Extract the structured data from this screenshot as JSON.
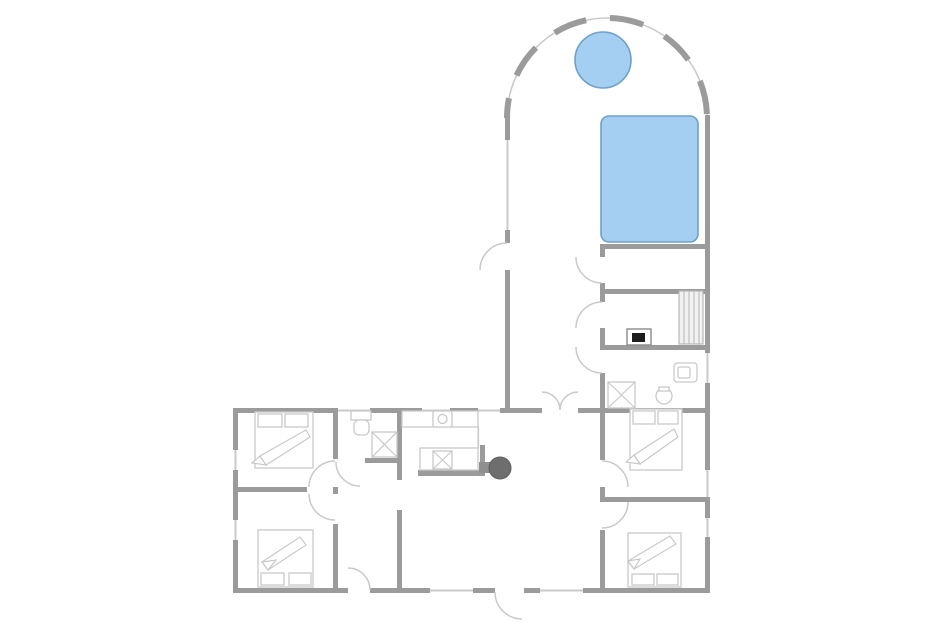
{
  "canvas": {
    "width": 950,
    "height": 634
  },
  "palette": {
    "bg": "#ffffff",
    "wall": "#9b9b9b",
    "window": "#c9c9c9",
    "fixture": "#c9c9c9",
    "water-fill": "#a5cff2",
    "water-stroke": "#6fa0c8",
    "heater": "#1c1c1c"
  },
  "shapes": [
    {
      "name": "arch-wall-underlay",
      "tag": "path",
      "cls": "archline",
      "d": "M 507 118 A 100 100 0 0 1 707 118"
    },
    {
      "name": "arch-wall-dashes",
      "tag": "path",
      "cls": "archdash",
      "d": "M 507 118 A 100 100 0 0 1 707 118",
      "dash": "34 24",
      "doff": "14"
    },
    {
      "name": "pool-left-wall-upper",
      "tag": "rect",
      "cls": "wall",
      "x": 505,
      "y": 115,
      "w": 5,
      "h": 25
    },
    {
      "name": "pool-left-wall-window",
      "tag": "rect",
      "cls": "win",
      "x": 506.5,
      "y": 140,
      "w": 2,
      "h": 90
    },
    {
      "name": "pool-left-wall-stub",
      "tag": "rect",
      "cls": "wall",
      "x": 505,
      "y": 230,
      "w": 5,
      "h": 13
    },
    {
      "name": "pool-left-wall-lower",
      "tag": "rect",
      "cls": "wall",
      "x": 505,
      "y": 270,
      "w": 5,
      "h": 138
    },
    {
      "name": "right-wall-upper",
      "tag": "rect",
      "cls": "wall",
      "x": 705,
      "y": 115,
      "w": 5,
      "h": 238
    },
    {
      "name": "right-wall-window-bath",
      "tag": "rect",
      "cls": "win",
      "x": 706.5,
      "y": 353,
      "w": 2,
      "h": 30
    },
    {
      "name": "right-wall-mid",
      "tag": "rect",
      "cls": "wall",
      "x": 705,
      "y": 383,
      "w": 5,
      "h": 87
    },
    {
      "name": "right-wall-window-bedroom1",
      "tag": "rect",
      "cls": "win",
      "x": 706.5,
      "y": 470,
      "w": 2,
      "h": 27
    },
    {
      "name": "right-wall-seg2",
      "tag": "rect",
      "cls": "wall",
      "x": 705,
      "y": 497,
      "w": 5,
      "h": 21
    },
    {
      "name": "right-wall-window-bedroom2",
      "tag": "rect",
      "cls": "win",
      "x": 706.5,
      "y": 518,
      "w": 2,
      "h": 19
    },
    {
      "name": "right-wall-lower",
      "tag": "rect",
      "cls": "wall",
      "x": 705,
      "y": 537,
      "w": 5,
      "h": 56
    },
    {
      "name": "pool-room-south-wall",
      "tag": "rect",
      "cls": "wall",
      "x": 600,
      "y": 244,
      "w": 110,
      "h": 5
    },
    {
      "name": "sauna-north-wall",
      "tag": "rect",
      "cls": "wall",
      "x": 600,
      "y": 289,
      "w": 110,
      "h": 5
    },
    {
      "name": "sauna-south-wall",
      "tag": "rect",
      "cls": "wall",
      "x": 600,
      "y": 345,
      "w": 110,
      "h": 5
    },
    {
      "name": "corridor-east-wall-stub1",
      "tag": "rect",
      "cls": "wall",
      "x": 600,
      "y": 244,
      "w": 5,
      "h": 13
    },
    {
      "name": "corridor-east-wall-stub2",
      "tag": "rect",
      "cls": "wall",
      "x": 600,
      "y": 283,
      "w": 5,
      "h": 19
    },
    {
      "name": "corridor-east-wall-stub3",
      "tag": "rect",
      "cls": "wall",
      "x": 600,
      "y": 328,
      "w": 5,
      "h": 19
    },
    {
      "name": "bedrooms-west-wall-upper",
      "tag": "rect",
      "cls": "wall",
      "x": 600,
      "y": 373,
      "w": 5,
      "h": 87
    },
    {
      "name": "bedrooms-west-wall-mid",
      "tag": "rect",
      "cls": "wall",
      "x": 600,
      "y": 487,
      "w": 5,
      "h": 15
    },
    {
      "name": "bedrooms-west-wall-lower",
      "tag": "rect",
      "cls": "wall",
      "x": 600,
      "y": 530,
      "w": 5,
      "h": 63
    },
    {
      "name": "wing-north-wall-seg1",
      "tag": "rect",
      "cls": "wall",
      "x": 233,
      "y": 408,
      "w": 102,
      "h": 5
    },
    {
      "name": "wing-north-window1",
      "tag": "rect",
      "cls": "win",
      "x": 335,
      "y": 409.5,
      "w": 35,
      "h": 2
    },
    {
      "name": "wing-north-wall-seg2",
      "tag": "rect",
      "cls": "wall",
      "x": 370,
      "y": 408,
      "w": 52,
      "h": 5
    },
    {
      "name": "wing-north-window2",
      "tag": "rect",
      "cls": "win",
      "x": 422,
      "y": 409.5,
      "w": 28,
      "h": 2
    },
    {
      "name": "wing-north-wall-seg3",
      "tag": "rect",
      "cls": "wall",
      "x": 450,
      "y": 408,
      "w": 28,
      "h": 5
    },
    {
      "name": "wing-north-window3",
      "tag": "rect",
      "cls": "win",
      "x": 478,
      "y": 409.5,
      "w": 22,
      "h": 2
    },
    {
      "name": "wing-north-wall-seg4",
      "tag": "rect",
      "cls": "wall",
      "x": 500,
      "y": 408,
      "w": 42,
      "h": 5
    },
    {
      "name": "wing-north-wall-seg5",
      "tag": "rect",
      "cls": "wall",
      "x": 578,
      "y": 408,
      "w": 132,
      "h": 5
    },
    {
      "name": "left-wall-seg1",
      "tag": "rect",
      "cls": "wall",
      "x": 233,
      "y": 408,
      "w": 5,
      "h": 42
    },
    {
      "name": "left-wall-window1",
      "tag": "rect",
      "cls": "win",
      "x": 234.5,
      "y": 450,
      "w": 2,
      "h": 20
    },
    {
      "name": "left-wall-seg2",
      "tag": "rect",
      "cls": "wall",
      "x": 233,
      "y": 470,
      "w": 5,
      "h": 50
    },
    {
      "name": "left-wall-window2",
      "tag": "rect",
      "cls": "win",
      "x": 234.5,
      "y": 520,
      "w": 2,
      "h": 20
    },
    {
      "name": "left-wall-seg3",
      "tag": "rect",
      "cls": "wall",
      "x": 233,
      "y": 540,
      "w": 5,
      "h": 53
    },
    {
      "name": "south-wall-seg1",
      "tag": "rect",
      "cls": "wall",
      "x": 233,
      "y": 588,
      "w": 115,
      "h": 5
    },
    {
      "name": "south-wall-seg2",
      "tag": "rect",
      "cls": "wall",
      "x": 370,
      "y": 588,
      "w": 60,
      "h": 5
    },
    {
      "name": "south-window1",
      "tag": "rect",
      "cls": "win",
      "x": 430,
      "y": 589.5,
      "w": 43,
      "h": 2
    },
    {
      "name": "south-wall-seg3",
      "tag": "rect",
      "cls": "wall",
      "x": 473,
      "y": 588,
      "w": 22,
      "h": 5
    },
    {
      "name": "south-wall-seg4",
      "tag": "rect",
      "cls": "wall",
      "x": 524,
      "y": 588,
      "w": 16,
      "h": 5
    },
    {
      "name": "south-window2",
      "tag": "rect",
      "cls": "win",
      "x": 540,
      "y": 589.5,
      "w": 43,
      "h": 2
    },
    {
      "name": "south-wall-seg5",
      "tag": "rect",
      "cls": "wall",
      "x": 583,
      "y": 588,
      "w": 127,
      "h": 5
    },
    {
      "name": "bedroom-divider-left",
      "tag": "rect",
      "cls": "wall",
      "x": 233,
      "y": 487,
      "w": 74,
      "h": 5
    },
    {
      "name": "bedroom-divider-right",
      "tag": "rect",
      "cls": "wall",
      "x": 603,
      "y": 497,
      "w": 107,
      "h": 5
    },
    {
      "name": "hall-west-wall-upper",
      "tag": "rect",
      "cls": "wall",
      "x": 333,
      "y": 408,
      "w": 5,
      "h": 51
    },
    {
      "name": "hall-west-wall-stub",
      "tag": "rect",
      "cls": "wall",
      "x": 333,
      "y": 487,
      "w": 5,
      "h": 7
    },
    {
      "name": "hall-west-wall-lower",
      "tag": "rect",
      "cls": "wall",
      "x": 333,
      "y": 524,
      "w": 5,
      "h": 69
    },
    {
      "name": "kitchen-west-wall",
      "tag": "rect",
      "cls": "wall",
      "x": 397,
      "y": 408,
      "w": 5,
      "h": 72
    },
    {
      "name": "vestibule-east-wall",
      "tag": "rect",
      "cls": "wall",
      "x": 397,
      "y": 510,
      "w": 5,
      "h": 83
    },
    {
      "name": "bathroom-hall-south-wall",
      "tag": "rect",
      "cls": "wall",
      "x": 365,
      "y": 458,
      "w": 37,
      "h": 5
    },
    {
      "name": "kitchen-knee-wall-south",
      "tag": "rect",
      "cls": "wall",
      "x": 418,
      "y": 470,
      "w": 67,
      "h": 6
    },
    {
      "name": "kitchen-knee-wall-east",
      "tag": "rect",
      "cls": "wall",
      "x": 480,
      "y": 445,
      "w": 5,
      "h": 31
    },
    {
      "name": "hot-tub",
      "tag": "circle",
      "cls": "water",
      "cx": 603,
      "cy": 60,
      "r": 28
    },
    {
      "name": "swimming-pool",
      "tag": "rect",
      "cls": "water",
      "x": 601,
      "y": 116,
      "w": 97,
      "h": 126,
      "rx": 8
    },
    {
      "name": "sauna-bench",
      "tag": "rect",
      "cls": "bench",
      "x": 679,
      "y": 291,
      "w": 24,
      "h": 53
    },
    {
      "name": "sauna-bench-slats",
      "tag": "path",
      "cls": "stripe",
      "d": "M 684 291 L 684 344 M 689 291 L 689 344 M 694 291 L 694 344 M 699 291 L 699 344"
    },
    {
      "name": "sauna-heater-body",
      "tag": "rect",
      "cls": "heatbox",
      "x": 627,
      "y": 329,
      "w": 24,
      "h": 16
    },
    {
      "name": "sauna-heater-core",
      "tag": "rect",
      "cls": "heatcore",
      "x": 632,
      "y": 333,
      "w": 13,
      "h": 9
    },
    {
      "name": "bathroom-shower",
      "tag": "rect",
      "cls": "fx",
      "x": 608,
      "y": 382,
      "w": 27,
      "h": 26
    },
    {
      "name": "bathroom-shower-cross",
      "tag": "path",
      "cls": "fxline",
      "d": "M 608 382 L 635 408 M 635 382 L 608 408"
    },
    {
      "name": "bathroom-sink",
      "tag": "circle",
      "cls": "fx",
      "cx": 664,
      "cy": 396,
      "r": 8
    },
    {
      "name": "bathroom-sink-tap",
      "tag": "rect",
      "cls": "fx",
      "x": 659,
      "y": 387,
      "w": 10,
      "h": 4
    },
    {
      "name": "bathroom-toilet",
      "tag": "rect",
      "cls": "fx",
      "x": 674,
      "y": 363,
      "w": 23,
      "h": 19,
      "rx": 3
    },
    {
      "name": "bathroom-toilet-seat",
      "tag": "rect",
      "cls": "fx",
      "x": 678,
      "y": 367,
      "w": 12,
      "h": 11,
      "rx": 2
    },
    {
      "name": "hall-toilet-cistern",
      "tag": "rect",
      "cls": "fx",
      "x": 351,
      "y": 411,
      "w": 20,
      "h": 9
    },
    {
      "name": "hall-toilet-bowl",
      "tag": "rect",
      "cls": "fx",
      "x": 354,
      "y": 420,
      "w": 15,
      "h": 15,
      "rx": 5
    },
    {
      "name": "hall-shower",
      "tag": "rect",
      "cls": "fx",
      "x": 372,
      "y": 432,
      "w": 25,
      "h": 25
    },
    {
      "name": "hall-shower-cross",
      "tag": "path",
      "cls": "fxline",
      "d": "M 372 432 L 397 457 M 397 432 L 372 457"
    },
    {
      "name": "kitchen-counter-top",
      "tag": "rect",
      "cls": "fx",
      "x": 402,
      "y": 411,
      "w": 76,
      "h": 16
    },
    {
      "name": "kitchen-counter-edge",
      "tag": "rect",
      "cls": "win",
      "x": 477.5,
      "y": 427,
      "w": 1.6,
      "h": 21
    },
    {
      "name": "kitchen-island",
      "tag": "rect",
      "cls": "fx",
      "x": 420,
      "y": 448,
      "w": 58,
      "h": 22
    },
    {
      "name": "kitchen-sink",
      "tag": "rect",
      "cls": "fx",
      "x": 433,
      "y": 411,
      "w": 19,
      "h": 16,
      "rx": 2
    },
    {
      "name": "kitchen-sink-drain",
      "tag": "circle",
      "cls": "fx",
      "cx": 442.5,
      "cy": 419,
      "r": 4.5
    },
    {
      "name": "kitchen-stove",
      "tag": "rect",
      "cls": "fx",
      "x": 433,
      "y": 451,
      "w": 19,
      "h": 18
    },
    {
      "name": "kitchen-stove-cross",
      "tag": "path",
      "cls": "fxline",
      "d": "M 433 451 L 452 469 M 452 451 L 433 469"
    },
    {
      "name": "wood-stove-flue",
      "tag": "rect",
      "cls": "stovebody",
      "x": 479,
      "y": 462,
      "w": 15,
      "h": 11
    },
    {
      "name": "wood-stove",
      "tag": "circle",
      "cls": "stovetop",
      "cx": 500,
      "cy": 468,
      "r": 11
    },
    {
      "name": "bed-nw-frame",
      "tag": "rect",
      "cls": "fx",
      "x": 255,
      "y": 412,
      "w": 58,
      "h": 56
    },
    {
      "name": "bed-nw-pillow-left",
      "tag": "rect",
      "cls": "fx",
      "x": 258,
      "y": 414,
      "w": 24,
      "h": 13
    },
    {
      "name": "bed-nw-pillow-right",
      "tag": "rect",
      "cls": "fx",
      "x": 285,
      "y": 414,
      "w": 23,
      "h": 13
    },
    {
      "name": "bed-nw-duvet",
      "tag": "polygon",
      "cls": "duvet",
      "points": "306,430 260,456 266,465 310,437"
    },
    {
      "name": "bed-nw-duvet-fold",
      "tag": "polygon",
      "cls": "duvet",
      "points": "260,456 266,465 252,463"
    },
    {
      "name": "bed-sw-frame",
      "tag": "rect",
      "cls": "fx",
      "x": 258,
      "y": 530,
      "w": 55,
      "h": 57
    },
    {
      "name": "bed-sw-pillow-left",
      "tag": "rect",
      "cls": "fx",
      "x": 261,
      "y": 573,
      "w": 23,
      "h": 12
    },
    {
      "name": "bed-sw-pillow-right",
      "tag": "rect",
      "cls": "fx",
      "x": 289,
      "y": 573,
      "w": 22,
      "h": 12
    },
    {
      "name": "bed-sw-duvet",
      "tag": "polygon",
      "cls": "duvet",
      "points": "268,570 306,545 300,537 262,562"
    },
    {
      "name": "bed-sw-duvet-fold",
      "tag": "polygon",
      "cls": "duvet",
      "points": "268,570 262,562 276,560"
    },
    {
      "name": "bed-ne-frame",
      "tag": "rect",
      "cls": "fx",
      "x": 630,
      "y": 409,
      "w": 52,
      "h": 61
    },
    {
      "name": "bed-ne-pillow-left",
      "tag": "rect",
      "cls": "fx",
      "x": 633,
      "y": 411,
      "w": 22,
      "h": 13
    },
    {
      "name": "bed-ne-pillow-right",
      "tag": "rect",
      "cls": "fx",
      "x": 658,
      "y": 411,
      "w": 20,
      "h": 13
    },
    {
      "name": "bed-ne-duvet",
      "tag": "polygon",
      "cls": "duvet",
      "points": "674,429 634,455 640,464 678,437"
    },
    {
      "name": "bed-ne-duvet-fold",
      "tag": "polygon",
      "cls": "duvet",
      "points": "634,455 640,464 626,462"
    },
    {
      "name": "bed-se-frame",
      "tag": "rect",
      "cls": "fx",
      "x": 628,
      "y": 533,
      "w": 53,
      "h": 54
    },
    {
      "name": "bed-se-pillow-left",
      "tag": "rect",
      "cls": "fx",
      "x": 632,
      "y": 574,
      "w": 22,
      "h": 11
    },
    {
      "name": "bed-se-pillow-right",
      "tag": "rect",
      "cls": "fx",
      "x": 657,
      "y": 574,
      "w": 21,
      "h": 11
    },
    {
      "name": "bed-se-duvet",
      "tag": "polygon",
      "cls": "duvet",
      "points": "634,569 676,544 670,536 628,561"
    },
    {
      "name": "bed-se-duvet-fold",
      "tag": "polygon",
      "cls": "duvet",
      "points": "634,569 628,561 640,559"
    },
    {
      "name": "door-arc-pool-entry",
      "tag": "path",
      "cls": "arc",
      "d": "M 507 243 A 27 27 0 0 0 480 270"
    },
    {
      "name": "door-arc-changing-room",
      "tag": "path",
      "cls": "arc",
      "d": "M 602 283 A 26 26 0 0 1 576 257"
    },
    {
      "name": "door-arc-sauna",
      "tag": "path",
      "cls": "arc",
      "d": "M 602 302 A 26 26 0 0 0 576 328"
    },
    {
      "name": "door-arc-bathroom",
      "tag": "path",
      "cls": "arc",
      "d": "M 602 373 A 26 26 0 0 1 576 347"
    },
    {
      "name": "door-arc-double-left",
      "tag": "path",
      "cls": "arc",
      "d": "M 542 392 A 18 18 0 0 1 560 410"
    },
    {
      "name": "door-arc-double-right",
      "tag": "path",
      "cls": "arc",
      "d": "M 578 392 A 18 18 0 0 0 560 410"
    },
    {
      "name": "door-arc-hall-bathroom",
      "tag": "path",
      "cls": "arc",
      "d": "M 336 462 A 24 24 0 0 0 360 486"
    },
    {
      "name": "door-arc-bedroom-nw",
      "tag": "path",
      "cls": "arc",
      "d": "M 335 461 A 26 26 0 0 0 309 487"
    },
    {
      "name": "door-arc-bedroom-sw",
      "tag": "path",
      "cls": "arc",
      "d": "M 335 520 A 26 26 0 0 1 309 494"
    },
    {
      "name": "door-arc-bedroom-ne",
      "tag": "path",
      "cls": "arc",
      "d": "M 602 461 A 26 26 0 0 1 628 487"
    },
    {
      "name": "door-arc-bedroom-se",
      "tag": "path",
      "cls": "arc",
      "d": "M 602 528 A 26 26 0 0 0 628 502"
    },
    {
      "name": "door-arc-terrace",
      "tag": "path",
      "cls": "arc",
      "d": "M 370 590 A 22 22 0 0 0 348 568"
    },
    {
      "name": "door-arc-main-entrance",
      "tag": "path",
      "cls": "arc",
      "d": "M 495 592 A 27 27 0 0 0 522 619"
    }
  ]
}
